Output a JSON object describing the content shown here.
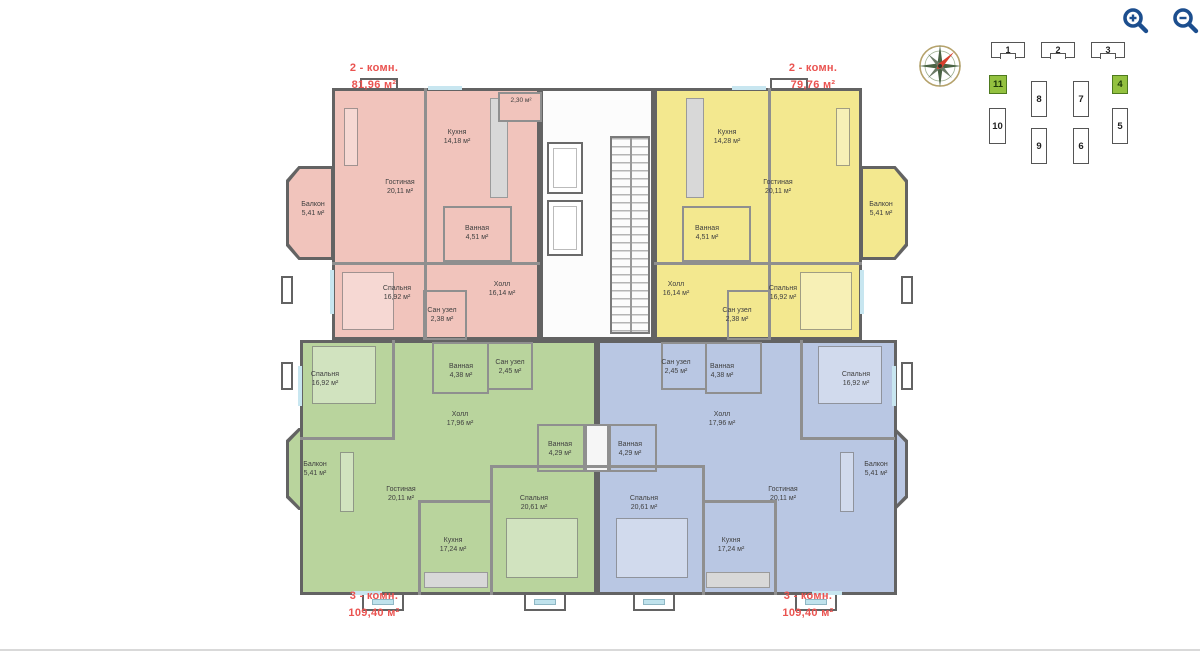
{
  "icons": {
    "zoom_in": "magnifier-plus-icon",
    "zoom_out": "magnifier-minus-icon",
    "compass": "compass-rose-icon"
  },
  "apartments": {
    "top_left": {
      "type": "2 - комн.",
      "area": "81,96 м²",
      "color": "#f1c4bc"
    },
    "top_right": {
      "type": "2 - комн.",
      "area": "79,76 м²",
      "color": "#f3e88f"
    },
    "bottom_left": {
      "type": "3 - комн.",
      "area": "109,40 м²",
      "color": "#b9d49d"
    },
    "bottom_right": {
      "type": "3 - комн.",
      "area": "109,40 м²",
      "color": "#b9c7e3"
    }
  },
  "rooms": {
    "top_left": [
      {
        "name": "Кухня",
        "area": "14,18 м²"
      },
      {
        "name": "Гостиная",
        "area": "20,11 м²"
      },
      {
        "name": "Балкон",
        "area": "5,41 м²"
      },
      {
        "name": "Ванная",
        "area": "4,51 м²"
      },
      {
        "name": "Спальня",
        "area": "16,92 м²"
      },
      {
        "name": "Сан узел",
        "area": "2,38 м²"
      },
      {
        "name": "Холл",
        "area": "16,14 м²"
      }
    ],
    "top_right": [
      {
        "name": "Кухня",
        "area": "14,28 м²"
      },
      {
        "name": "Гостиная",
        "area": "20,11 м²"
      },
      {
        "name": "Балкон",
        "area": "5,41 м²"
      },
      {
        "name": "Ванная",
        "area": "4,51 м²"
      },
      {
        "name": "Спальня",
        "area": "16,92 м²"
      },
      {
        "name": "Сан узел",
        "area": "2,38 м²"
      },
      {
        "name": "Холл",
        "area": "16,14 м²"
      }
    ],
    "bottom_left": [
      {
        "name": "Спальня",
        "area": "16,92 м²"
      },
      {
        "name": "Ванная",
        "area": "4,38 м²"
      },
      {
        "name": "Сан узел",
        "area": "2,45 м²"
      },
      {
        "name": "Холл",
        "area": "17,96 м²"
      },
      {
        "name": "Ванная",
        "area": "4,29 м²"
      },
      {
        "name": "Балкон",
        "area": "5,41 м²"
      },
      {
        "name": "Гостиная",
        "area": "20,11 м²"
      },
      {
        "name": "Спальня",
        "area": "20,61 м²"
      },
      {
        "name": "Кухня",
        "area": "17,24 м²"
      }
    ],
    "bottom_right": [
      {
        "name": "Спальня",
        "area": "16,92 м²"
      },
      {
        "name": "Ванная",
        "area": "4,38 м²"
      },
      {
        "name": "Сан узел",
        "area": "2,45 м²"
      },
      {
        "name": "Холл",
        "area": "17,96 м²"
      },
      {
        "name": "Ванная",
        "area": "4,29 м²"
      },
      {
        "name": "Балкон",
        "area": "5,41 м²"
      },
      {
        "name": "Гостиная",
        "area": "20,11 м²"
      },
      {
        "name": "Спальня",
        "area": "20,61 м²"
      },
      {
        "name": "Кухня",
        "area": "17,24 м²"
      }
    ]
  },
  "core": {
    "storage_area": "2,30 м²"
  },
  "unit_selector": {
    "floors_row": [
      {
        "label": "1"
      },
      {
        "label": "2"
      },
      {
        "label": "3"
      }
    ],
    "units": [
      {
        "label": "11",
        "highlighted": true
      },
      {
        "label": "8",
        "highlighted": false
      },
      {
        "label": "7",
        "highlighted": false
      },
      {
        "label": "4",
        "highlighted": true
      },
      {
        "label": "10",
        "highlighted": false
      },
      {
        "label": "9",
        "highlighted": false
      },
      {
        "label": "6",
        "highlighted": false
      },
      {
        "label": "5",
        "highlighted": false
      }
    ],
    "highlight_color": "#93c13f"
  },
  "colors": {
    "label_red": "#ea5350",
    "wall_dark": "#636363",
    "wall_light": "#8f8f8f",
    "window_blue": "#c8e6f0",
    "zoom_icon_blue": "#1c4e8e"
  }
}
